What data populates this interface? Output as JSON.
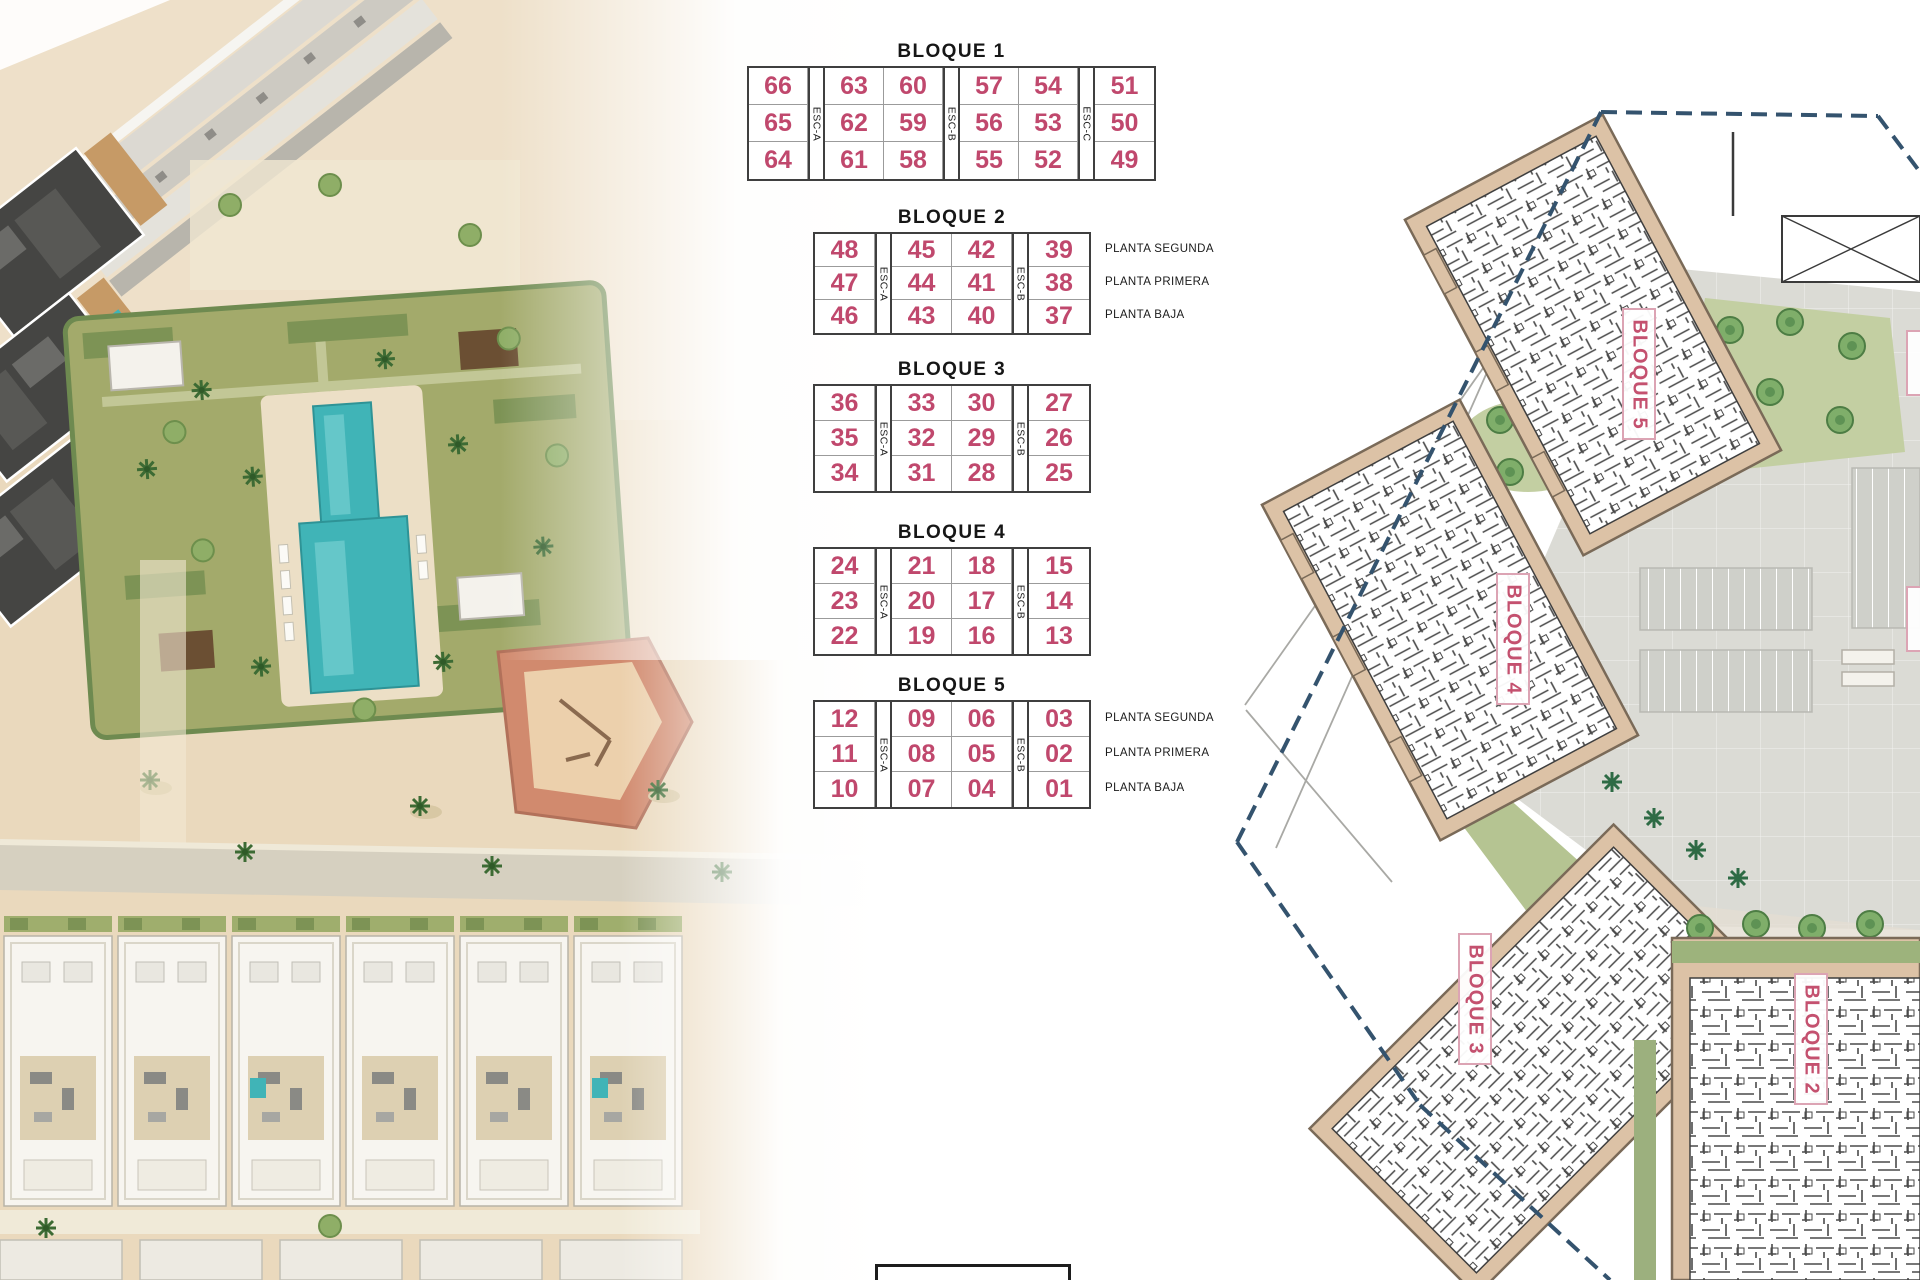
{
  "legend_tables": [
    {
      "title": "BLOQUE 1",
      "esc_labels": [
        "ESC-A",
        "ESC-B",
        "ESC-C"
      ],
      "rows": [
        [
          "66",
          "63",
          "60",
          "57",
          "54",
          "51"
        ],
        [
          "65",
          "62",
          "59",
          "56",
          "53",
          "50"
        ],
        [
          "64",
          "61",
          "58",
          "55",
          "52",
          "49"
        ]
      ],
      "floors": []
    },
    {
      "title": "BLOQUE 2",
      "esc_labels": [
        "ESC-A",
        "ESC-B"
      ],
      "rows": [
        [
          "48",
          "45",
          "42",
          "39"
        ],
        [
          "47",
          "44",
          "41",
          "38"
        ],
        [
          "46",
          "43",
          "40",
          "37"
        ]
      ],
      "floors": [
        "PLANTA SEGUNDA",
        "PLANTA PRIMERA",
        "PLANTA BAJA"
      ]
    },
    {
      "title": "BLOQUE 3",
      "esc_labels": [
        "ESC-A",
        "ESC-B"
      ],
      "rows": [
        [
          "36",
          "33",
          "30",
          "27"
        ],
        [
          "35",
          "32",
          "29",
          "26"
        ],
        [
          "34",
          "31",
          "28",
          "25"
        ]
      ],
      "floors": []
    },
    {
      "title": "BLOQUE 4",
      "esc_labels": [
        "ESC-A",
        "ESC-B"
      ],
      "rows": [
        [
          "24",
          "21",
          "18",
          "15"
        ],
        [
          "23",
          "20",
          "17",
          "14"
        ],
        [
          "22",
          "19",
          "16",
          "13"
        ]
      ],
      "floors": []
    },
    {
      "title": "BLOQUE 5",
      "esc_labels": [
        "ESC-A",
        "ESC-B"
      ],
      "rows": [
        [
          "12",
          "09",
          "06",
          "03"
        ],
        [
          "11",
          "08",
          "05",
          "02"
        ],
        [
          "10",
          "07",
          "04",
          "01"
        ]
      ],
      "floors": [
        "PLANTA SEGUNDA",
        "PLANTA PRIMERA",
        "PLANTA BAJA"
      ]
    }
  ],
  "site_plan": {
    "block_labels": [
      "BLOQUE 5",
      "BLOQUE 4",
      "BLOQUE 3",
      "BLOQUE 2"
    ]
  },
  "colors": {
    "unit_number": "#c0486d",
    "plan_label": "#c4516f",
    "boundary_dash": "#34536e",
    "building_fill": "#dcc2a6",
    "pool": "#40b4b7",
    "garden": "#a3aa6b",
    "sand": "#ead9bd",
    "road_gray": "#d6d0c0"
  }
}
